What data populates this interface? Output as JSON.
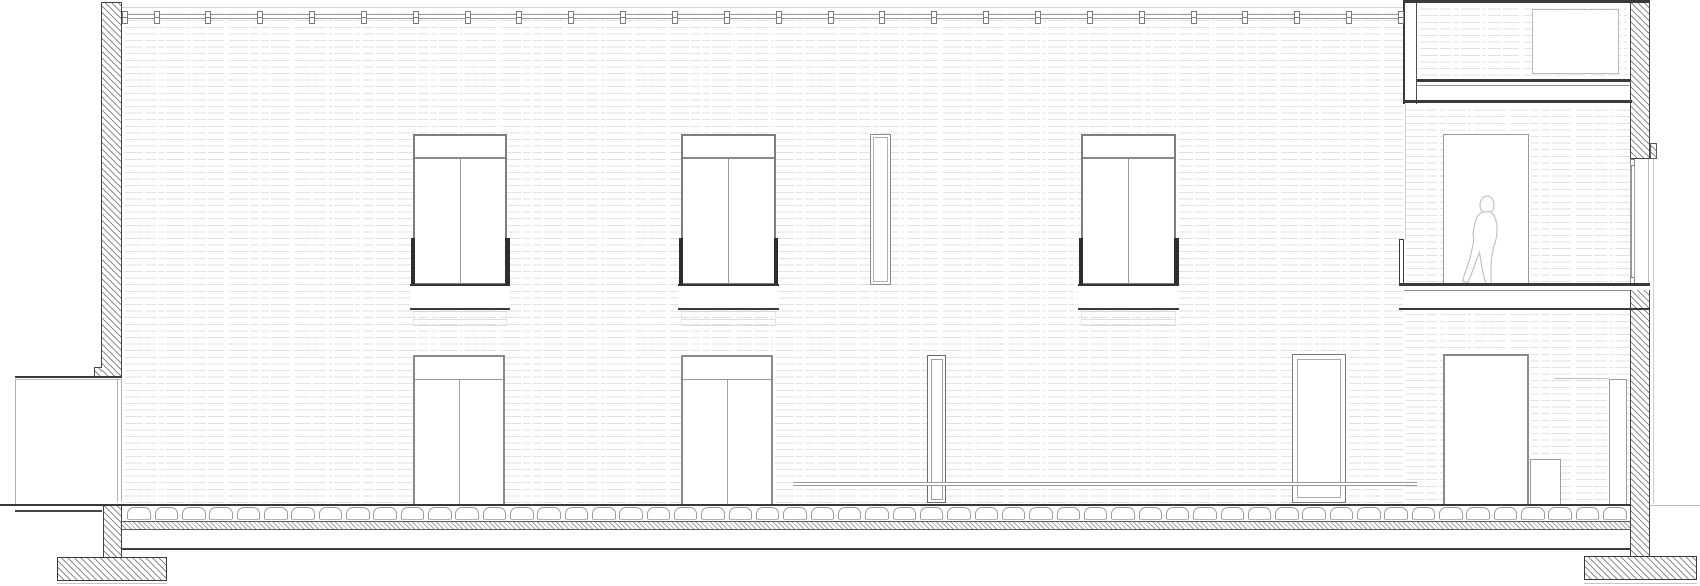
{
  "document": {
    "kind": "architectural longitudinal section drawing",
    "visible_text": [],
    "canvas": {
      "width_px": 1700,
      "height_px": 586
    }
  },
  "palette": {
    "paper": "#ffffff",
    "cut_line_dark": "#3a3a3a",
    "frame_gray": "#8a8a8a",
    "light_gray": "#c4c4c4",
    "brick_texture": "#e2e2e2",
    "hatch_gray": "#8f8f8f",
    "guardrail_dark": "#2e2e2e",
    "figure_outline": "#c2c2c2"
  },
  "counts": {
    "roof_rail_clips": 26,
    "floor_pavers": 55,
    "upper_windows": 3,
    "lower_doors": 3,
    "narrow_glazed_slots": 3
  },
  "entourage": {
    "person_figures": 1
  }
}
